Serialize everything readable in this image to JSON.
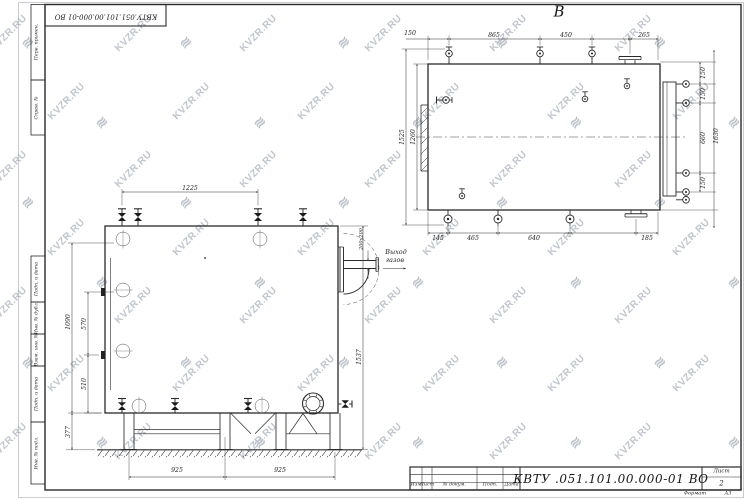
{
  "watermark": {
    "text": "KVZR.RU",
    "logo_glyph": "≋",
    "color": "#c0c5cd"
  },
  "frame": {
    "top_stamp": "КВТУ.051.101.00.000-01 ВО",
    "left_margin_top": [
      "Перв. примен.",
      "Справ. №"
    ],
    "left_margin_bottom": [
      "Подп. и дата",
      "Инв. № дубл.",
      "Взам. инв. №",
      "Подп. и дата",
      "Инв. № подл."
    ]
  },
  "title_block": {
    "doc_number": "КВТУ .051.101.00.000-01  ВО",
    "columns": [
      "Изм",
      "Лист",
      "№ докум.",
      "Подп.",
      "Дата"
    ],
    "sheet_label": "Лист",
    "sheet_number": "2",
    "format_label": "Формат",
    "format_value": "А3"
  },
  "views": {
    "top": {
      "label": "В",
      "dims_top": [
        "150",
        "865",
        "450",
        "265"
      ],
      "dims_bottom": [
        "145",
        "465",
        "640",
        "185"
      ],
      "dims_left": [
        "1525",
        "1260"
      ],
      "dims_right": [
        "150",
        "150",
        "660",
        "150"
      ],
      "dim_overall": "1630"
    },
    "front": {
      "dim_top": "1225",
      "dims_left": [
        "1090",
        "570",
        "510",
        "377"
      ],
      "dim_right": "1537",
      "dims_bottom": [
        "925",
        "925"
      ],
      "outlet_size": "200х200",
      "outlet_text": [
        "Выход",
        "газов"
      ]
    }
  }
}
